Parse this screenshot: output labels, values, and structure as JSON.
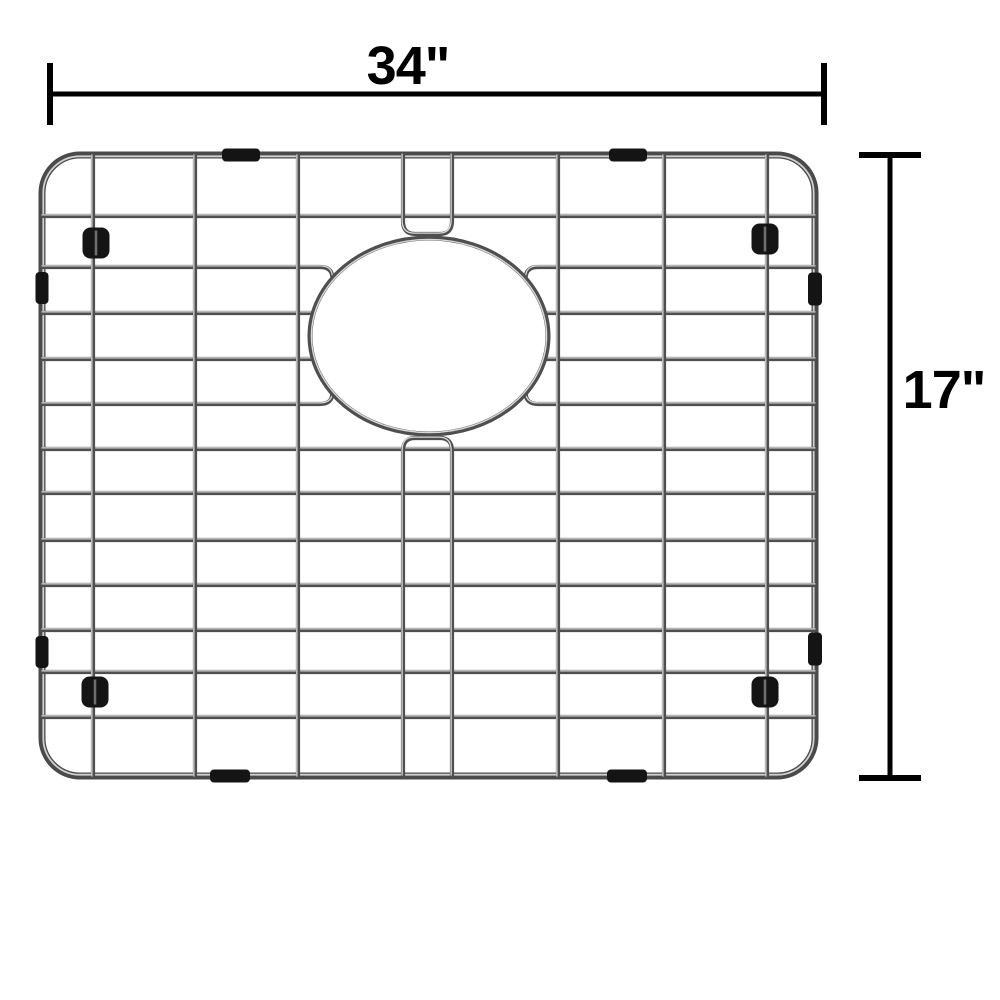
{
  "page": {
    "description": "Dimension diagram of a stainless steel kitchen sink bottom grid with rounded corners, a center oval drain opening, black rubber corner feet and side bumpers",
    "background": "#ffffff"
  },
  "annotations": {
    "width_label": "34\"",
    "height_label": "17\""
  },
  "colors": {
    "annotation": "#000000",
    "wire_body": "#4f4f4f",
    "wire_highlight": "#d8d8d8",
    "frame_body": "#4a4a4a",
    "frame_highlight": "#d0d0d0",
    "rubber": "#141414",
    "rubber_slit": "#6e6e6e",
    "background": "#ffffff"
  },
  "geometry": {
    "frame": {
      "x": 42,
      "y": 155,
      "w": 773,
      "h": 621,
      "r": 38,
      "stroke": 7,
      "highlight_stroke": 1.8
    },
    "wire_stroke": 4.2,
    "wire_highlight_stroke": 1.3,
    "horizontal_wires_y": [
      216,
      267,
      313,
      359,
      404,
      449,
      493,
      540,
      585,
      630,
      672,
      717
    ],
    "inner_interrupted_y": [
      313,
      359
    ],
    "outer_interrupted_y": [
      267,
      404
    ],
    "inner_end_left_x": 313,
    "inner_end_right_x": 545,
    "funnel_end_left_x": 320,
    "funnel_end_right_x": 538,
    "vertical_wires_x": [
      93,
      195,
      298,
      558,
      664,
      767
    ],
    "split_pair": {
      "x1": 403,
      "x2": 452,
      "top_v_end": 221,
      "top_u_y": 234,
      "bottom_v_start": 451,
      "bottom_u_y": 438,
      "corner": 12
    },
    "drain_ring": {
      "cx": 429,
      "cy": 336,
      "rx": 119,
      "ry": 98,
      "stroke": 5
    },
    "feet": [
      {
        "cx": 96,
        "cy": 243
      },
      {
        "cx": 765,
        "cy": 239
      },
      {
        "cx": 95,
        "cy": 692
      },
      {
        "cx": 765,
        "cy": 692
      }
    ],
    "foot_size": {
      "w": 27,
      "h": 31,
      "r": 8
    },
    "clips": [
      {
        "cx": 241,
        "cy": 155,
        "w": 38,
        "h": 13
      },
      {
        "cx": 628,
        "cy": 155,
        "w": 38,
        "h": 13
      },
      {
        "cx": 230,
        "cy": 776,
        "w": 40,
        "h": 13
      },
      {
        "cx": 627,
        "cy": 776,
        "w": 40,
        "h": 13
      },
      {
        "cx": 42,
        "cy": 288,
        "w": 13,
        "h": 32
      },
      {
        "cx": 42,
        "cy": 652,
        "w": 13,
        "h": 32
      },
      {
        "cx": 815,
        "cy": 289,
        "w": 14,
        "h": 33
      },
      {
        "cx": 815,
        "cy": 649,
        "w": 14,
        "h": 33
      }
    ],
    "width_dim": {
      "y": 94,
      "x1": 50,
      "x2": 824,
      "line_w": 5,
      "tick_w": 6,
      "tick_half": 31,
      "label_cx": 408,
      "label_cy": 66
    },
    "height_dim": {
      "x": 890,
      "y1": 155,
      "y2": 778,
      "line_w": 5,
      "tick_w": 6,
      "tick_half": 31,
      "label_cx": 944,
      "label_cy": 390
    }
  }
}
